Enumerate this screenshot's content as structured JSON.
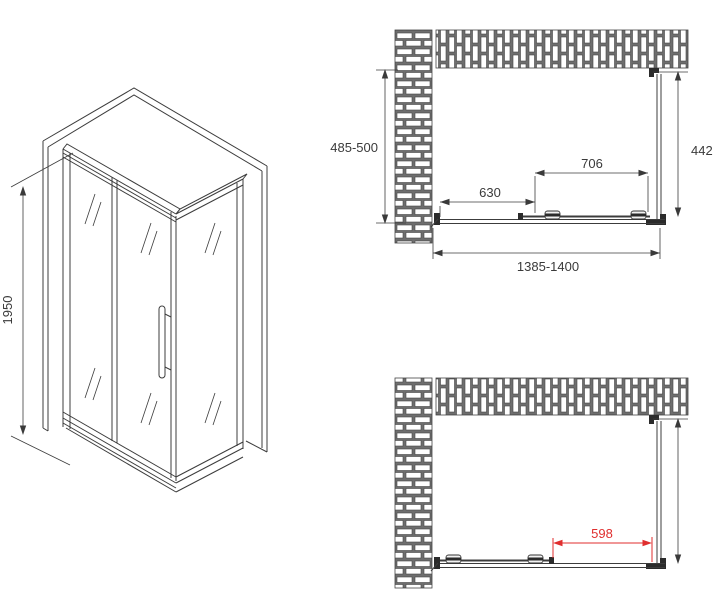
{
  "drawing": {
    "type": "shower-enclosure-technical-drawing",
    "background": "#ffffff",
    "colors": {
      "line": "#3c3c3c",
      "dimension_text": "#3a3a3a",
      "dimension_red": "#e02e2e",
      "brick_mortar": "#6e6e6e",
      "brick_fill": "#ffffff"
    },
    "isometric_view": {
      "height_label": "1950"
    },
    "top_plan_view": {
      "depth_label": "485-500",
      "side_panel_label": "442",
      "door_panel_label": "706",
      "fixed_panel_label": "630",
      "total_width_label": "1385-1400"
    },
    "bottom_plan_view": {
      "door_opening_label": "598"
    }
  }
}
